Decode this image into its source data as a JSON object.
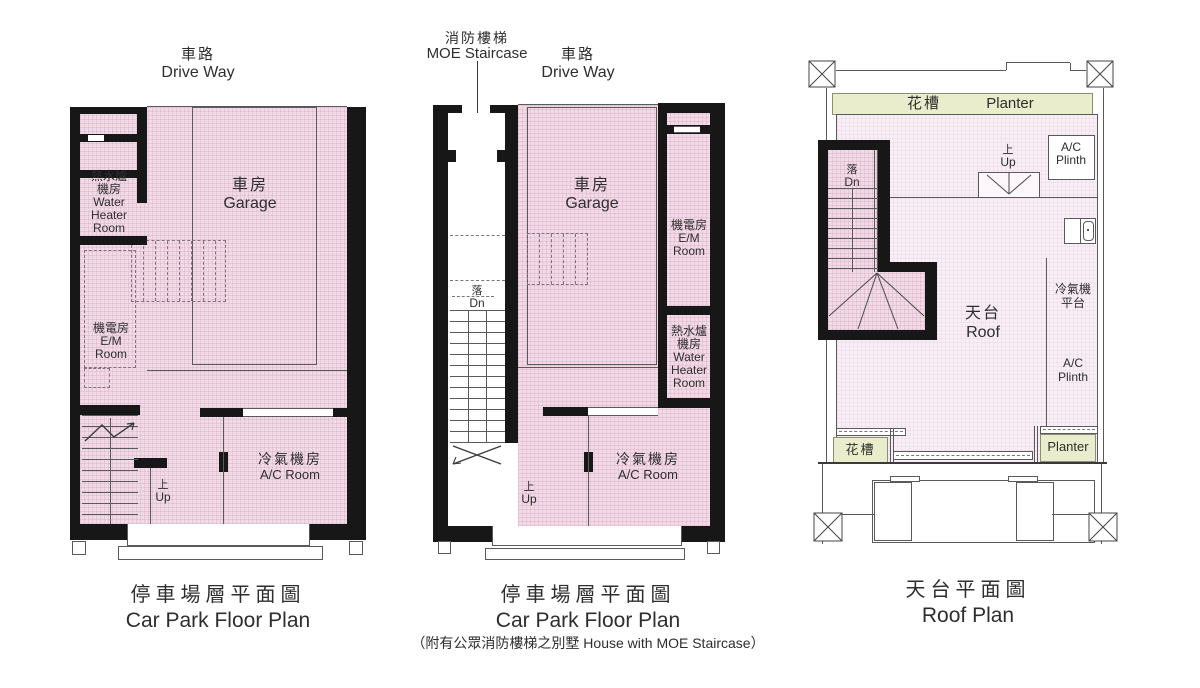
{
  "colors": {
    "wall": "#171717",
    "fill_pink": "#f1d9e6",
    "fill_roof": "#f8eef5",
    "fill_planter_green": "#e9edcb",
    "line": "#5a5a5a",
    "text": "#2e2e2e"
  },
  "plans": {
    "carpark": {
      "driveway": {
        "zh": "車路",
        "en": "Drive Way"
      },
      "garage": {
        "zh": "車房",
        "en": "Garage"
      },
      "water_heater": {
        "l1": "熱水爐",
        "l2": "機房",
        "l3": "Water",
        "l4": "Heater",
        "l5": "Room"
      },
      "em_room": {
        "l1": "機電房",
        "l2": "E/M",
        "l3": "Room"
      },
      "ac_room": {
        "zh": "冷氣機房",
        "en": "A/C Room"
      },
      "up": {
        "zh": "上",
        "en": "Up"
      },
      "caption": {
        "zh": "停車場層平面圖",
        "en": "Car Park Floor Plan"
      }
    },
    "carpark_moe": {
      "moe": {
        "zh": "消防樓梯",
        "en": "MOE Staircase"
      },
      "driveway": {
        "zh": "車路",
        "en": "Drive Way"
      },
      "garage": {
        "zh": "車房",
        "en": "Garage"
      },
      "em_room": {
        "l1": "機電房",
        "l2": "E/M",
        "l3": "Room"
      },
      "water_heater": {
        "l1": "熱水爐",
        "l2": "機房",
        "l3": "Water",
        "l4": "Heater",
        "l5": "Room"
      },
      "ac_room": {
        "zh": "冷氣機房",
        "en": "A/C Room"
      },
      "dn": {
        "zh": "落",
        "en": "Dn"
      },
      "up": {
        "zh": "上",
        "en": "Up"
      },
      "caption": {
        "zh": "停車場層平面圖",
        "en": "Car Park Floor Plan",
        "note": "（附有公眾消防樓梯之別墅 House with MOE Staircase）"
      }
    },
    "roof": {
      "planter_top": {
        "zh": "花槽",
        "en": "Planter"
      },
      "roof": {
        "zh": "天台",
        "en": "Roof"
      },
      "ac_plinth_top": {
        "l1": "A/C",
        "l2": "Plinth"
      },
      "ac_platform": {
        "l1": "冷氣機",
        "l2": "平台"
      },
      "ac_plinth_right": {
        "l1": "A/C",
        "l2": "Plinth"
      },
      "dn": {
        "zh": "落",
        "en": "Dn"
      },
      "up": {
        "zh": "上",
        "en": "Up"
      },
      "planter_bottom_left": {
        "zh": "花槽"
      },
      "planter_bottom_right": {
        "en": "Planter"
      },
      "caption": {
        "zh": "天台平面圖",
        "en": "Roof Plan"
      }
    }
  }
}
